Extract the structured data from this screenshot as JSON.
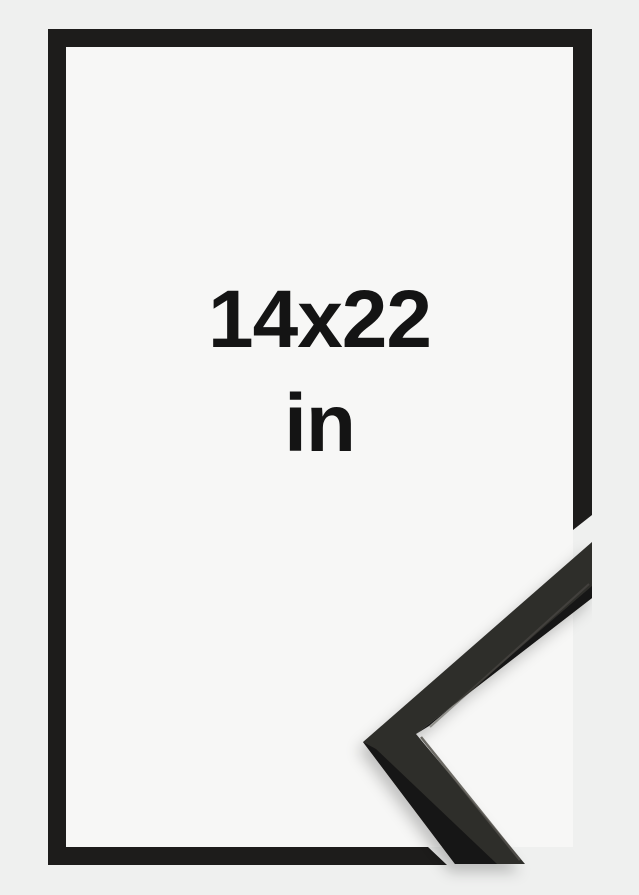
{
  "image": {
    "description": "Black picture frame size mockup with enlarged corner profile detail",
    "label": {
      "dimensions": "14x22",
      "unit": "in"
    },
    "colors": {
      "background": "#eff0ef",
      "paper": "#f7f7f6",
      "frame": "#1d1c1b",
      "profile_face": "#2f2e2b",
      "profile_edge_dark": "#171614",
      "profile_highlight": "#54524c",
      "text": "#141414"
    }
  }
}
